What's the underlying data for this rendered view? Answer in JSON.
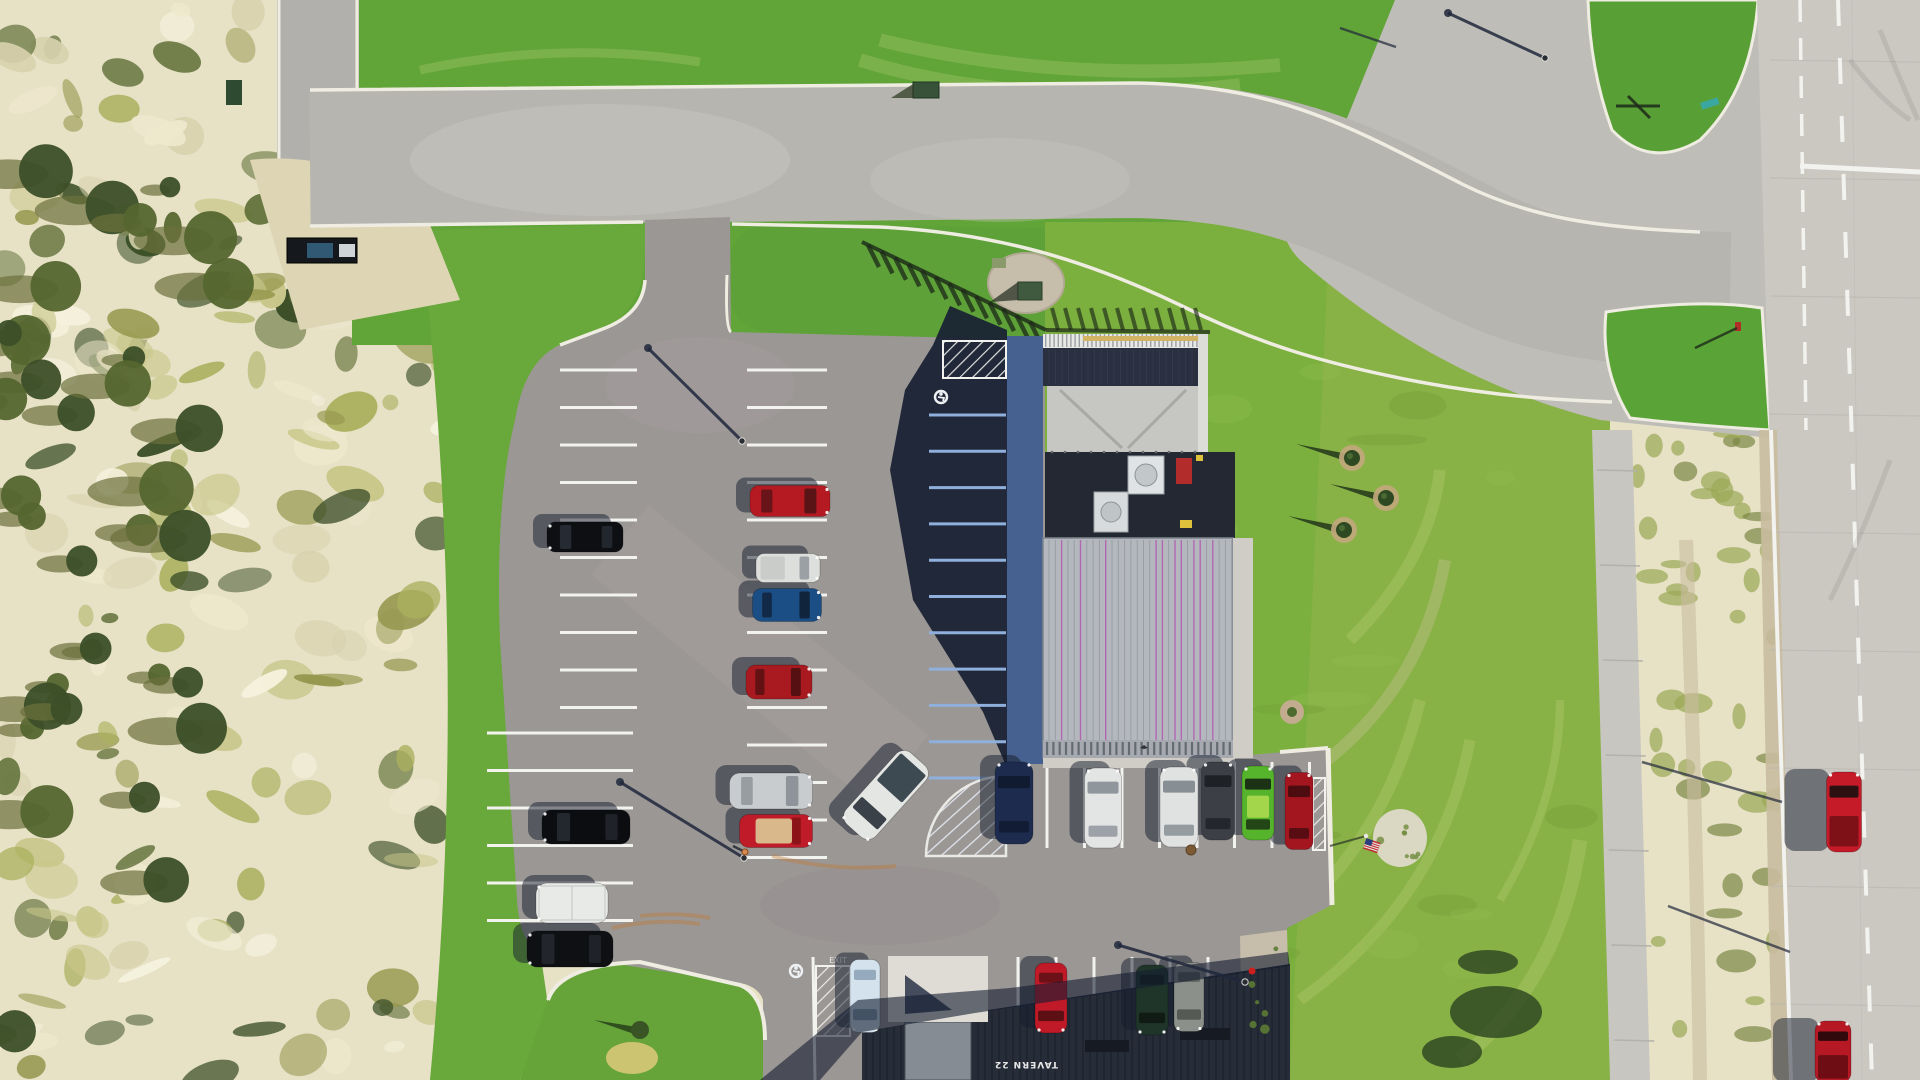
{
  "scene": {
    "title": "aerial-drone-view-tavern-parking-lot",
    "width": 1920,
    "height": 1080
  },
  "signs": {
    "tavern": "TAVERN 22",
    "pavement_exit": "EXIT"
  },
  "colors": {
    "sand": "#e7e1c6",
    "sandLight": "#f5f1dd",
    "scrubOlive": "#97984f",
    "treeDark": "#3c4f28",
    "grass": "#61a438",
    "grassLight": "#83b842",
    "grassField": "#7cb03e",
    "grassEast": "#8cb14a",
    "road": "#b6b4af",
    "roadLight": "#c8c6c0",
    "junction": "#bfbdb7",
    "highway": "#cbc8c2",
    "shoulder": "#c9bda0",
    "sidewalk": "#c8c6c0",
    "curb": "#efece2",
    "asphalt": "#9b9795",
    "shadow": "#1a2133",
    "lineWhite": "#f2f2ee",
    "lineShadowBlue": "#8fb0dc",
    "sidewalkShaded": "#46618f",
    "roof": "#b4b8be",
    "roofRib": "#959ba3",
    "roofMagenta": "#b168b1",
    "roofBand": "#a6aab0",
    "lowerRoof": "#262c38",
    "patio": "#c6c6c2",
    "railing": "#e8e8e4",
    "railYellow": "#d2b464",
    "mech": "#232833",
    "hvac": "#e0e3e5",
    "redBox": "#b32c2c",
    "gravel": "#c6bdab",
    "rockWhite": "#ded9c9",
    "flagRed": "#c03030",
    "flagBlue": "#2a3d7c",
    "skid": "#c07a34"
  },
  "vehicles": [
    {
      "name": "black-suv-west-row",
      "cx": 585,
      "cy": 537,
      "w": 30,
      "l": 76,
      "rot": -90,
      "body": "#0d0f13",
      "glass": "#262b33",
      "kind": "suv"
    },
    {
      "name": "black-sedan-west-row",
      "cx": 586,
      "cy": 827,
      "w": 34,
      "l": 88,
      "rot": -90,
      "body": "#0b0d11",
      "glass": "#23272e",
      "kind": "sedan"
    },
    {
      "name": "white-box-van",
      "cx": 572,
      "cy": 903,
      "w": 40,
      "l": 72,
      "rot": -90,
      "body": "#e8eae8",
      "glass": "#c8cac8",
      "kind": "box"
    },
    {
      "name": "black-car-west-row",
      "cx": 570,
      "cy": 949,
      "w": 36,
      "l": 86,
      "rot": -90,
      "body": "#0e1014",
      "glass": "#22262c",
      "kind": "sedan"
    },
    {
      "name": "red-sedan-mid-row",
      "cx": 790,
      "cy": 501,
      "w": 31,
      "l": 80,
      "rot": 90,
      "body": "#b51a22",
      "glass": "#5a1416",
      "kind": "sedan"
    },
    {
      "name": "white-pickup-mid-row",
      "cx": 788,
      "cy": 568,
      "w": 29,
      "l": 64,
      "rot": 90,
      "body": "#dddfdd",
      "glass": "#9aa0a4",
      "kind": "pickup",
      "bed": "#c9ccc9"
    },
    {
      "name": "blue-sedan-mid-row",
      "cx": 787,
      "cy": 605,
      "w": 33,
      "l": 69,
      "rot": 90,
      "body": "#1c4e86",
      "glass": "#10243c",
      "kind": "sedan"
    },
    {
      "name": "red-sedan-2-mid-row",
      "cx": 779,
      "cy": 682,
      "w": 34,
      "l": 66,
      "rot": 90,
      "body": "#a81a20",
      "glass": "#571012",
      "kind": "sedan"
    },
    {
      "name": "silver-sedan-mid-row",
      "cx": 771,
      "cy": 791,
      "w": 36,
      "l": 83,
      "rot": 90,
      "body": "#c9ccce",
      "glass": "#8e9499",
      "kind": "sedan"
    },
    {
      "name": "red-convertible",
      "cx": 776,
      "cy": 831,
      "w": 33,
      "l": 73,
      "rot": 90,
      "body": "#bf1b28",
      "glass": "#8c1418",
      "kind": "convertible",
      "interior": "#d9b98c"
    },
    {
      "name": "white-pickup-in-aisle",
      "cx": 886,
      "cy": 795,
      "w": 40,
      "l": 96,
      "rot": 222,
      "body": "#e4e6e4",
      "glass": "#3a4148",
      "kind": "pickup",
      "bed": "#3e4a52"
    },
    {
      "name": "navy-car-front-row",
      "cx": 1014,
      "cy": 803,
      "w": 38,
      "l": 82,
      "rot": 0,
      "body": "#1d2c4e",
      "glass": "#101a30",
      "kind": "sedan"
    },
    {
      "name": "white-car-front-row",
      "cx": 1103,
      "cy": 808,
      "w": 37,
      "l": 80,
      "rot": 0,
      "body": "#e3e5e4",
      "glass": "#8f979c",
      "kind": "sedan"
    },
    {
      "name": "white-suv-front-row",
      "cx": 1179,
      "cy": 807,
      "w": 38,
      "l": 80,
      "rot": 0,
      "body": "#e0e2e1",
      "glass": "#878f94",
      "kind": "suv"
    },
    {
      "name": "dark-gray-car-front-row",
      "cx": 1218,
      "cy": 801,
      "w": 33,
      "l": 78,
      "rot": 0,
      "body": "#3c4046",
      "glass": "#1e2226",
      "kind": "sedan"
    },
    {
      "name": "green-car-front-row",
      "cx": 1258,
      "cy": 803,
      "w": 32,
      "l": 74,
      "rot": 0,
      "body": "#55b42c",
      "glass": "#1c3214",
      "kind": "sedan",
      "stripe": "#b2dc50"
    },
    {
      "name": "red-car-front-row-east",
      "cx": 1299,
      "cy": 811,
      "w": 28,
      "l": 77,
      "rot": 0,
      "body": "#a3151f",
      "glass": "#4c0c10",
      "kind": "sedan"
    },
    {
      "name": "pale-blue-car-south-row",
      "cx": 865,
      "cy": 996,
      "w": 30,
      "l": 73,
      "rot": 180,
      "body": "#d3e2ec",
      "glass": "#8aa0b4",
      "kind": "sedan"
    },
    {
      "name": "red-car-south-row",
      "cx": 1051,
      "cy": 998,
      "w": 32,
      "l": 70,
      "rot": 180,
      "body": "#c01a28",
      "glass": "#5c1014",
      "kind": "sedan"
    },
    {
      "name": "dark-green-suv-south-row",
      "cx": 1152,
      "cy": 1000,
      "w": 32,
      "l": 70,
      "rot": 180,
      "body": "#20352a",
      "glass": "#101b15",
      "kind": "suv"
    },
    {
      "name": "gray-sedan-south-row",
      "cx": 1189,
      "cy": 997,
      "w": 30,
      "l": 69,
      "rot": 180,
      "body": "#8b908a",
      "glass": "#555a55",
      "kind": "sedan"
    },
    {
      "name": "red-pickup-on-highway",
      "cx": 1844,
      "cy": 812,
      "w": 35,
      "l": 80,
      "rot": 0,
      "body": "#c51a28",
      "glass": "#2c1012",
      "kind": "pickup",
      "bed": "#7e1018",
      "longShadow": true
    },
    {
      "name": "red-car-on-highway-south",
      "cx": 1833,
      "cy": 1052,
      "w": 36,
      "l": 62,
      "rot": 0,
      "body": "#b61824",
      "glass": "#30090c",
      "kind": "pickup",
      "bed": "#6e0e14",
      "longShadow": true
    }
  ],
  "parking_columns": [
    {
      "name": "west-column-upper",
      "type": "h",
      "from": 560,
      "to": 637,
      "start": 370,
      "count": 10,
      "step": 37.5,
      "color": "#f2f2ee"
    },
    {
      "name": "west-column-lower",
      "type": "h",
      "from": 487,
      "to": 633,
      "start": 733,
      "count": 6,
      "step": 37.5,
      "color": "#f2f2ee"
    },
    {
      "name": "middle-column",
      "type": "h",
      "from": 747,
      "to": 827,
      "start": 370,
      "count": 14,
      "step": 37.5,
      "color": "#f2f2ee"
    },
    {
      "name": "building-west-column-shaded",
      "type": "h",
      "from": 929,
      "to": 1006,
      "start": 415,
      "count": 11,
      "step": 36.3,
      "color": "#8fb0dc"
    },
    {
      "name": "building-front-row",
      "type": "v",
      "from": 762,
      "to": 848,
      "start": 1047,
      "count": 8,
      "step": 37.5,
      "color": "#f2f2ee"
    },
    {
      "name": "south-row",
      "type": "v",
      "from": 957,
      "to": 1035,
      "start": 1018,
      "count": 6,
      "step": 38,
      "color": "#f2f2ee"
    }
  ],
  "trees": {
    "evergreens": [
      {
        "x": 1352,
        "y": 458
      },
      {
        "x": 1386,
        "y": 498
      },
      {
        "x": 1344,
        "y": 530
      }
    ],
    "mound_tree": {
      "x": 640,
      "y": 1030
    }
  },
  "light_poles": [
    {
      "name": "lot-light-north",
      "base": [
        742,
        441
      ],
      "shadow_tip": [
        648,
        348
      ]
    },
    {
      "name": "lot-light-south",
      "base": [
        744,
        858
      ],
      "shadow_tip": [
        620,
        782
      ]
    },
    {
      "name": "lot-light-southeast",
      "base": [
        1245,
        982
      ],
      "shadow_tip": [
        1118,
        945
      ]
    },
    {
      "name": "street-light-junction",
      "base": [
        1545,
        58
      ],
      "shadow_tip": [
        1448,
        13
      ]
    }
  ],
  "shadow_lines": [
    [
      1340,
      28,
      1396,
      47
    ],
    [
      1642,
      762,
      1782,
      802
    ],
    [
      1668,
      906,
      1790,
      952
    ]
  ],
  "hatch_zones": [
    {
      "name": "no-park-hatch-shaded",
      "shape": "rect",
      "x": 943,
      "y": 341,
      "w": 63,
      "h": 37
    },
    {
      "name": "no-park-hatch-quarter",
      "shape": "quarter",
      "x": 1006,
      "y": 776,
      "r": 80
    },
    {
      "name": "handicap-aisle-hatch",
      "shape": "rect",
      "x": 816,
      "y": 966,
      "w": 34,
      "h": 70
    },
    {
      "name": "curb-hatch-east",
      "shape": "rect",
      "x": 1313,
      "y": 778,
      "w": 12,
      "h": 72
    }
  ],
  "pavement_markings": {
    "handicap_symbols": [
      [
        941,
        397
      ],
      [
        796,
        971
      ]
    ],
    "exit_text_pos": [
      838,
      963
    ],
    "exit_lane_line": [
      813,
      957,
      815,
      1080
    ],
    "stop_bar": [
      1800,
      166,
      1920,
      172
    ]
  },
  "street_furniture": {
    "manhole": [
      1191,
      850
    ],
    "hydrant": [
      1252,
      971
    ],
    "flag": [
      1366,
      836
    ],
    "white_rock_bed": [
      1400,
      838
    ],
    "shrub_rock_bed": [
      1292,
      712
    ],
    "utility_box_north": [
      913,
      82
    ],
    "utility_box_west": [
      226,
      80
    ],
    "black-trailer": [
      287,
      238
    ],
    "person": [
      745,
      852
    ],
    "teal_street_sign": [
      1710,
      104
    ],
    "red_sign": [
      1735,
      322
    ],
    "gravel_island_boxes": [
      1018,
      282
    ]
  }
}
